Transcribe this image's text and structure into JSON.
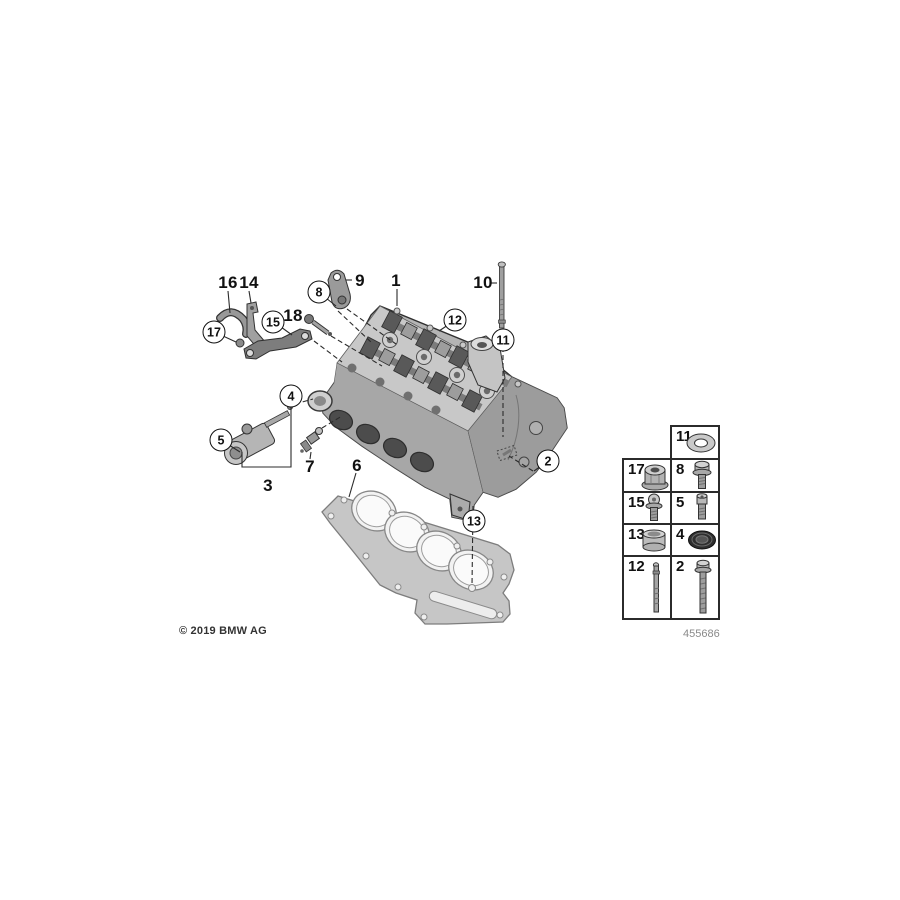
{
  "footer": {
    "copyright": "© 2019 BMW AG",
    "drawing_number": "455686"
  },
  "callouts": [
    {
      "label": "16",
      "type": "plain"
    },
    {
      "label": "14",
      "type": "plain"
    },
    {
      "label": "9",
      "type": "plain"
    },
    {
      "label": "1",
      "type": "plain"
    },
    {
      "label": "10",
      "type": "plain"
    },
    {
      "label": "18",
      "type": "plain"
    },
    {
      "label": "7",
      "type": "plain"
    },
    {
      "label": "3",
      "type": "plain"
    },
    {
      "label": "6",
      "type": "plain"
    },
    {
      "label": "8",
      "type": "circled"
    },
    {
      "label": "17",
      "type": "circled"
    },
    {
      "label": "15",
      "type": "circled"
    },
    {
      "label": "12",
      "type": "circled"
    },
    {
      "label": "11",
      "type": "circled"
    },
    {
      "label": "4",
      "type": "circled"
    },
    {
      "label": "5",
      "type": "circled"
    },
    {
      "label": "2",
      "type": "circled"
    },
    {
      "label": "13",
      "type": "circled"
    }
  ],
  "legend": {
    "cells": [
      {
        "num": "11",
        "icon": "washer"
      },
      {
        "num": "17",
        "icon": "flange-nut"
      },
      {
        "num": "8",
        "icon": "hex-bolt"
      },
      {
        "num": "15",
        "icon": "torx-flange-bolt"
      },
      {
        "num": "5",
        "icon": "socket-head-bolt"
      },
      {
        "num": "13",
        "icon": "dowel-sleeve"
      },
      {
        "num": "4",
        "icon": "seal-ring"
      },
      {
        "num": "12",
        "icon": "stud"
      },
      {
        "num": "2",
        "icon": "long-hex-bolt"
      }
    ]
  },
  "colors": {
    "label": "#111111",
    "leader_line": "#2b2b2b",
    "legend_border": "#2b2b2b",
    "drawing_number_gray": "#8a8a8a"
  }
}
